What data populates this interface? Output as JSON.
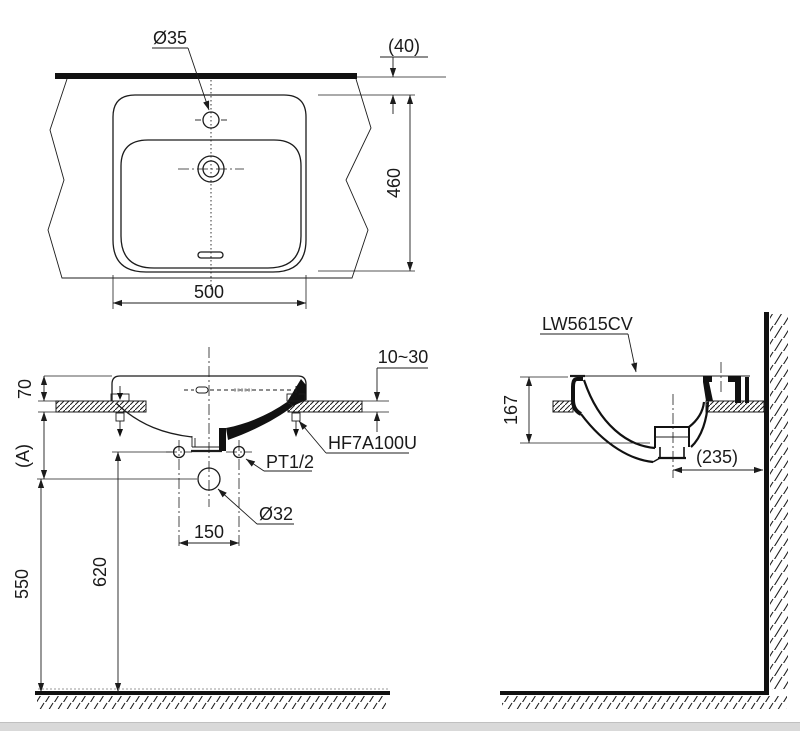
{
  "drawing": {
    "title_model": "LW5615CV",
    "colors": {
      "line": "#1c1c1c",
      "background": "#ffffff",
      "window_strip": "#d9d9d9"
    },
    "plan": {
      "faucet_hole_dia": "Ø35",
      "counter_gap": "(40)",
      "basin_depth": "460",
      "basin_width": "500"
    },
    "front": {
      "rim_height": "70",
      "dim_a": "(A)",
      "counter_thickness_range": "10~30",
      "bracket_model": "HF7A100U",
      "supply_thread": "PT1/2",
      "drain_dia": "Ø32",
      "supply_spacing": "150",
      "supply_height": "620",
      "drain_height": "550"
    },
    "side": {
      "model_code": "LW5615CV",
      "basin_height": "167",
      "drain_to_wall": "(235)"
    }
  }
}
